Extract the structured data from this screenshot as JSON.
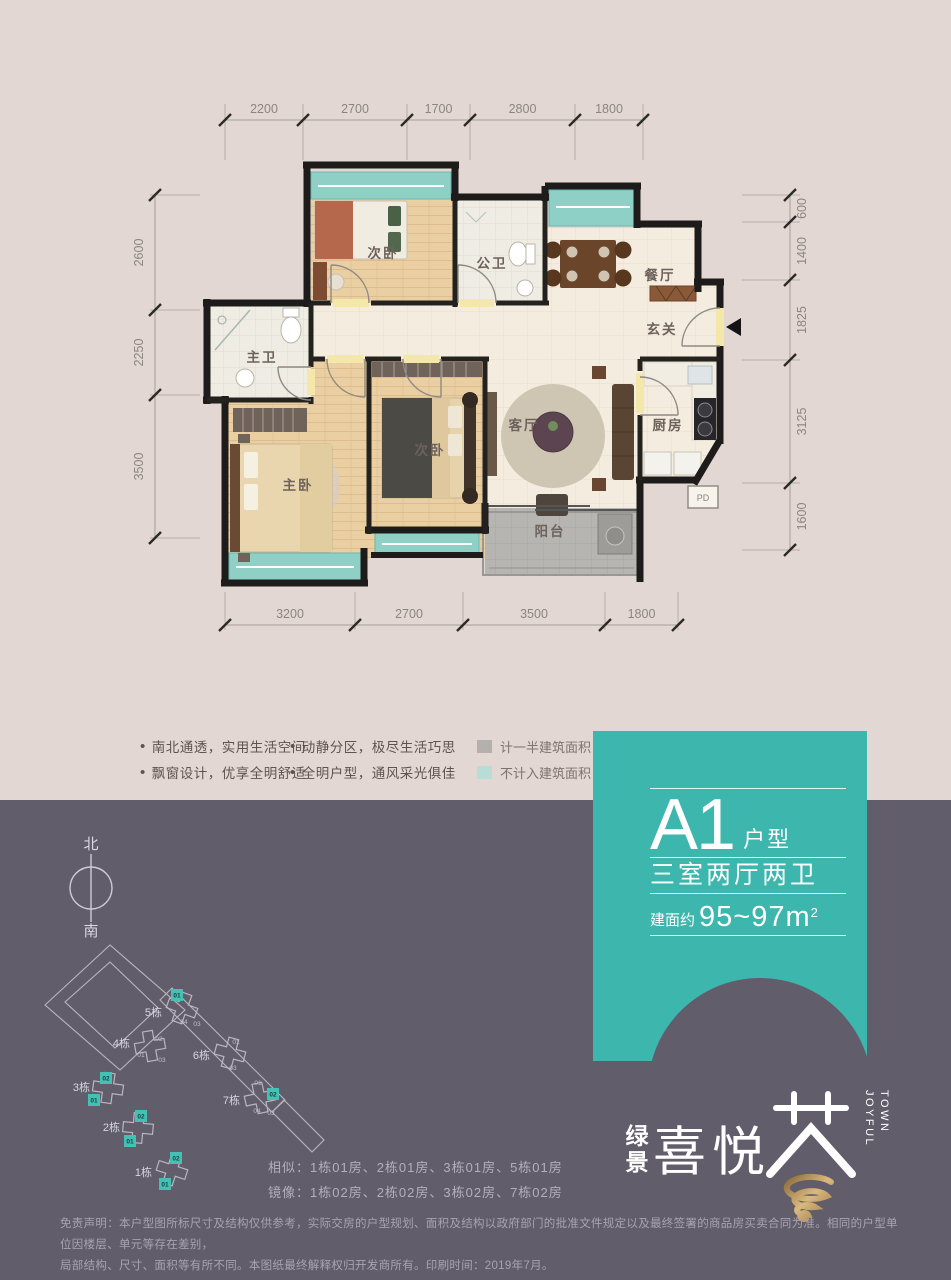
{
  "colors": {
    "bg-top": "#e3d7d4",
    "bg-bottom": "#615d6a",
    "accent": "#3db6ad",
    "legend-half": "#b3b0ad",
    "legend-excl": "#b7ddd7",
    "teal-window": "#8fd0c6",
    "wall": "#1d1c1a",
    "gold": "#bb9a66"
  },
  "plan": {
    "rooms": [
      {
        "name": "bedroom-2",
        "label": "次卧"
      },
      {
        "name": "public-bathroom",
        "label": "公卫"
      },
      {
        "name": "dining-room",
        "label": "餐厅"
      },
      {
        "name": "entryway",
        "label": "玄关"
      },
      {
        "name": "master-bathroom",
        "label": "主卫"
      },
      {
        "name": "bedroom-3",
        "label": "次卧"
      },
      {
        "name": "living-room",
        "label": "客厅"
      },
      {
        "name": "kitchen",
        "label": "厨房"
      },
      {
        "name": "master-bedroom",
        "label": "主卧"
      },
      {
        "name": "balcony",
        "label": "阳台"
      },
      {
        "name": "pipe-duct",
        "label": "PD"
      }
    ],
    "dims": {
      "top": [
        "2200",
        "2700",
        "1700",
        "2800",
        "1800"
      ],
      "left": [
        "2600",
        "2250",
        "3500"
      ],
      "right": [
        "600",
        "1400",
        "1825",
        "3125",
        "1600"
      ],
      "bottom": [
        "3200",
        "2700",
        "3500",
        "1800"
      ]
    }
  },
  "features": {
    "bullets": [
      "南北通透，实用生活空间",
      "动静分区，极尽生活巧思",
      "飘窗设计，优享全明舒适",
      "全明户型，通风采光俱佳"
    ],
    "legend": [
      {
        "label": "计一半建筑面积"
      },
      {
        "label": "不计入建筑面积"
      }
    ]
  },
  "card": {
    "code": "A1",
    "code_suffix": "户型",
    "layout": "三室两厅两卫",
    "area_prefix": "建面约",
    "area_value": "95~97m",
    "area_sup": "2"
  },
  "compass": {
    "north": "北",
    "south": "南"
  },
  "siteplan": {
    "buildings": [
      {
        "label": "5栋",
        "units": [
          {
            "id": "01",
            "hl": true
          },
          {
            "id": "04"
          },
          {
            "id": "03"
          }
        ]
      },
      {
        "label": "4栋",
        "units": [
          {
            "id": "01"
          },
          {
            "id": "02"
          },
          {
            "id": "03"
          }
        ]
      },
      {
        "label": "6栋",
        "units": [
          {
            "id": "01"
          },
          {
            "id": "03"
          }
        ]
      },
      {
        "label": "3栋",
        "units": [
          {
            "id": "02",
            "hl": true
          },
          {
            "id": "01",
            "hl": true
          }
        ]
      },
      {
        "label": "7栋",
        "units": [
          {
            "id": "02",
            "hl": true
          },
          {
            "id": "01"
          },
          {
            "id": "04"
          },
          {
            "id": "03"
          }
        ]
      },
      {
        "label": "2栋",
        "units": [
          {
            "id": "02",
            "hl": true
          },
          {
            "id": "01",
            "hl": true
          }
        ]
      },
      {
        "label": "1栋",
        "units": [
          {
            "id": "02",
            "hl": true
          },
          {
            "id": "01",
            "hl": true
          }
        ]
      }
    ],
    "similar": "相似：1栋01房、2栋01房、3栋01房、5栋01房",
    "mirror": "镜像：1栋02房、2栋02房、3栋02房、7栋02房"
  },
  "logo": {
    "brand_top": "绿",
    "brand_bottom": "景",
    "name": "喜悦",
    "english_1": "JOYFUL",
    "english_2": "TOWN"
  },
  "disclaimer": {
    "line1": "免责声明：本户型图所标尺寸及结构仅供参考，实际交房的户型规划、面积及结构以政府部门的批准文件规定以及最终签署的商品房买卖合同为准。相同的户型单位因楼层、单元等存在差别，",
    "line2": "局部结构、尺寸、面积等有所不同。本图纸最终解释权归开发商所有。印刷时间：2019年7月。"
  }
}
